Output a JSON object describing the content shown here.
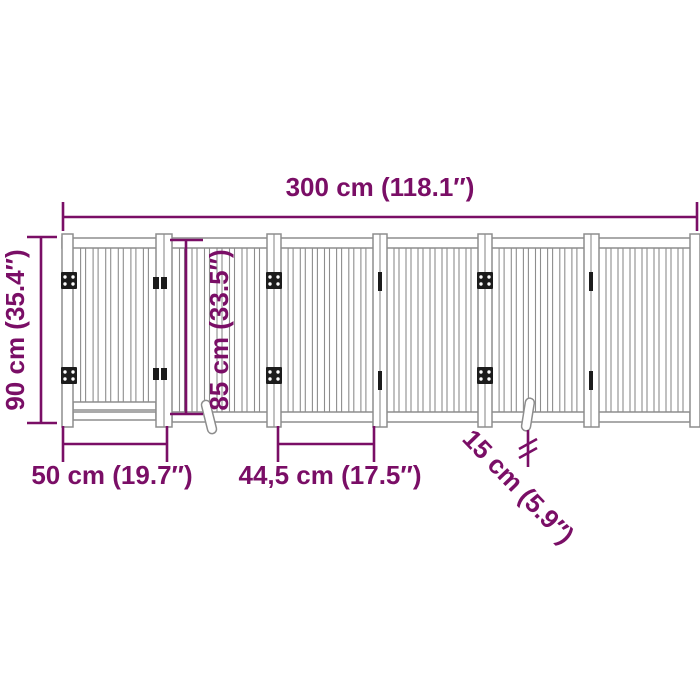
{
  "diagram_title": "Foldable dog gate dimension diagram",
  "colors": {
    "dimension": "#7a0e66",
    "outline": "#8d8d8d",
    "hardware": "#1c1c1c",
    "background": "#ffffff"
  },
  "dimensions": {
    "total_width": "300 cm (118.1″)",
    "overall_height": "90 cm (35.4″)",
    "inner_height": "85 cm (33.5″)",
    "gate_width": "50 cm (19.7″)",
    "panel_width": "44,5 cm (17.5″)",
    "foot_length": "15 cm (5.9″)"
  }
}
